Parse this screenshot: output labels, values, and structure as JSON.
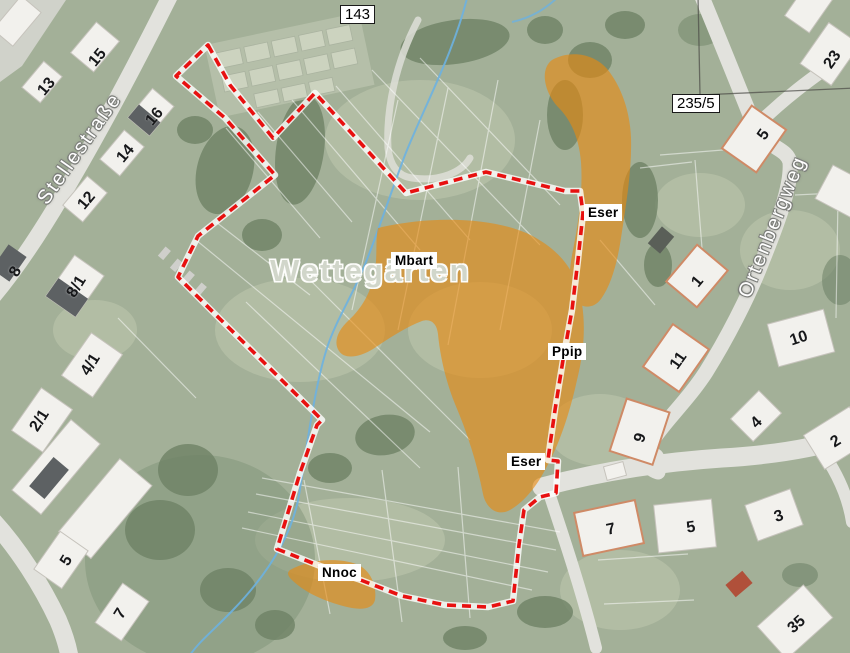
{
  "map": {
    "place_label": "Wettegärten",
    "streets": {
      "stellestrasse": "Stellestraße",
      "ortenbergweg": "Ortenbergweg"
    },
    "parcel_labels": {
      "p143": "143",
      "p235_5": "235/5"
    },
    "area_labels": {
      "eser_north": "Eser",
      "mbart": "Mbart",
      "ppip": "Ppip",
      "eser_south": "Eser",
      "nnoc": "Nnoc"
    },
    "house_numbers": [
      "15",
      "13",
      "16",
      "14",
      "12",
      "8",
      "8/1",
      "4/1",
      "2/1",
      "5",
      "7",
      "23",
      "5",
      "1",
      "11",
      "10",
      "9",
      "2",
      "4",
      "7",
      "5",
      "3",
      "35"
    ],
    "colors": {
      "site_boundary": "#e81010",
      "habitat_overlay": "#e8890f",
      "stream": "#6db1e0",
      "meadow": "#a3b098"
    }
  }
}
